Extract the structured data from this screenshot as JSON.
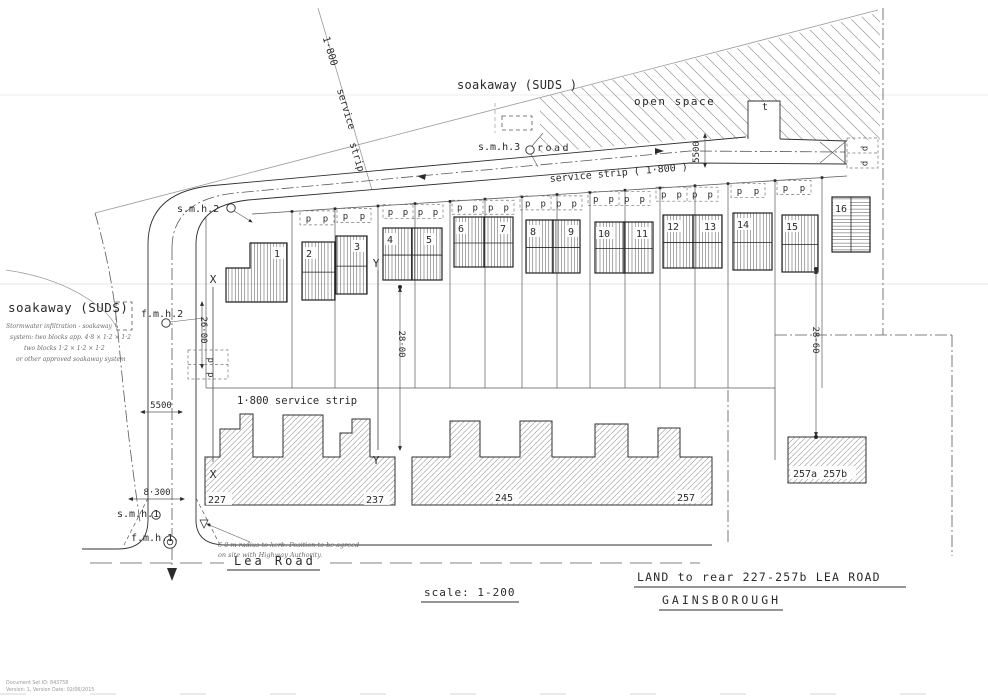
{
  "title_block": {
    "line1": "LAND to rear 227-257b LEA ROAD",
    "line2": "GAINSBOROUGH",
    "scale": "scale: 1-200"
  },
  "roads": {
    "lea_road": "Lea  Road",
    "road_label": "road",
    "turning_head": "t"
  },
  "labels": {
    "soakaway_top": "soakaway (SUDS )",
    "soakaway_left": "soakaway (SUDS)",
    "open_space": "open  space",
    "service_strip_diagonal": {
      "l1": "1·800",
      "l2": "service",
      "l3": "strip"
    },
    "service_strip_road": "service strip ( 1·800 )",
    "service_strip_rear": "1·800 service strip",
    "soakaway_note": [
      "Stormwater infiltration - soakaway",
      "system: two blocks app. 4·8 × 1·2 × 1·2",
      "two blocks 1·2 × 1·2 × 1·2",
      "or other approved soakaway system"
    ],
    "highway_note": [
      "6·0 m radius to kerb.   Position to be agreed",
      "on site with Highway Authority."
    ]
  },
  "manholes": {
    "smh1": "s.m.h.1",
    "fmh1": "f.m.h.1.",
    "smh2": "s.m.h.2",
    "fmh2": "f.m.h.2",
    "smh3": "s.m.h.3"
  },
  "dimensions": {
    "road_width_turning": "5500",
    "road_width_lea": "5500",
    "plot_depth_west": "26·00",
    "plot_depth_mid": "28·00",
    "plot_depth_east": "28·60",
    "junction_width": "8·300"
  },
  "section_markers": {
    "x": "X",
    "y": "Y"
  },
  "parking_symbol": "p",
  "plots": [
    {
      "number": "1",
      "poly": "250,243 287,243 287,302 226,302 226,268 250,268",
      "lx": 274,
      "ly": 257
    },
    {
      "number": "2",
      "x": 302,
      "y": 242,
      "w": 33,
      "h": 58,
      "lx": 306,
      "ly": 257
    },
    {
      "number": "3",
      "x": 336,
      "y": 236,
      "w": 31,
      "h": 58,
      "lx": 354,
      "ly": 250
    },
    {
      "number": "4",
      "x": 383,
      "y": 228,
      "w": 29,
      "h": 52,
      "lx": 387,
      "ly": 243
    },
    {
      "number": "5",
      "x": 412,
      "y": 228,
      "w": 30,
      "h": 52,
      "lx": 426,
      "ly": 243
    },
    {
      "number": "6",
      "x": 454,
      "y": 217,
      "w": 30,
      "h": 50,
      "lx": 458,
      "ly": 232
    },
    {
      "number": "7",
      "x": 484,
      "y": 217,
      "w": 29,
      "h": 50,
      "lx": 500,
      "ly": 232
    },
    {
      "number": "8",
      "x": 526,
      "y": 220,
      "w": 27,
      "h": 53,
      "lx": 530,
      "ly": 235
    },
    {
      "number": "9",
      "x": 553,
      "y": 220,
      "w": 27,
      "h": 53,
      "lx": 568,
      "ly": 235
    },
    {
      "number": "10",
      "x": 595,
      "y": 222,
      "w": 29,
      "h": 51,
      "lx": 598,
      "ly": 237
    },
    {
      "number": "11",
      "x": 624,
      "y": 222,
      "w": 29,
      "h": 51,
      "lx": 636,
      "ly": 237
    },
    {
      "number": "12",
      "x": 663,
      "y": 215,
      "w": 30,
      "h": 53,
      "lx": 667,
      "ly": 230
    },
    {
      "number": "13",
      "x": 693,
      "y": 215,
      "w": 29,
      "h": 53,
      "lx": 704,
      "ly": 230
    },
    {
      "number": "14",
      "x": 733,
      "y": 213,
      "w": 39,
      "h": 57,
      "lx": 737,
      "ly": 228
    },
    {
      "number": "15",
      "x": 782,
      "y": 215,
      "w": 36,
      "h": 57,
      "lx": 786,
      "ly": 230
    },
    {
      "number": "16",
      "x": 832,
      "y": 197,
      "w": 38,
      "h": 55,
      "lx": 835,
      "ly": 212,
      "hatch": "h"
    }
  ],
  "parking_groups": [
    {
      "x": 300,
      "w": 34,
      "n": 2
    },
    {
      "x": 337,
      "w": 34,
      "n": 2
    },
    {
      "x": 383,
      "w": 60,
      "n": 4
    },
    {
      "x": 452,
      "w": 62,
      "n": 4
    },
    {
      "x": 520,
      "w": 62,
      "n": 4
    },
    {
      "x": 588,
      "w": 62,
      "n": 4
    },
    {
      "x": 656,
      "w": 62,
      "n": 4
    },
    {
      "x": 731,
      "w": 34,
      "n": 2
    },
    {
      "x": 777,
      "w": 34,
      "n": 2
    },
    {
      "x": 847,
      "y": 138,
      "w": 31,
      "h": 30,
      "n": 2,
      "vert": true
    },
    {
      "x": 188,
      "y": 350,
      "w": 40,
      "h": 29,
      "n": 2,
      "vert": true
    }
  ],
  "plot_dividers": [
    292,
    335,
    378,
    415,
    450,
    485,
    522,
    557,
    590,
    625,
    660,
    695,
    728,
    775,
    822
  ],
  "existing_houses": {
    "n227": "227",
    "n237": "237",
    "n245": "245",
    "n257": "257",
    "n257ab": "257a 257b"
  },
  "footer": [
    "Document Set ID: 843758",
    "Version: 1, Version Date: 02/06/2015"
  ],
  "colors": {
    "ink": "#2f2f2f",
    "hatch": "#8c8c8c",
    "paper": "#ffffff"
  }
}
